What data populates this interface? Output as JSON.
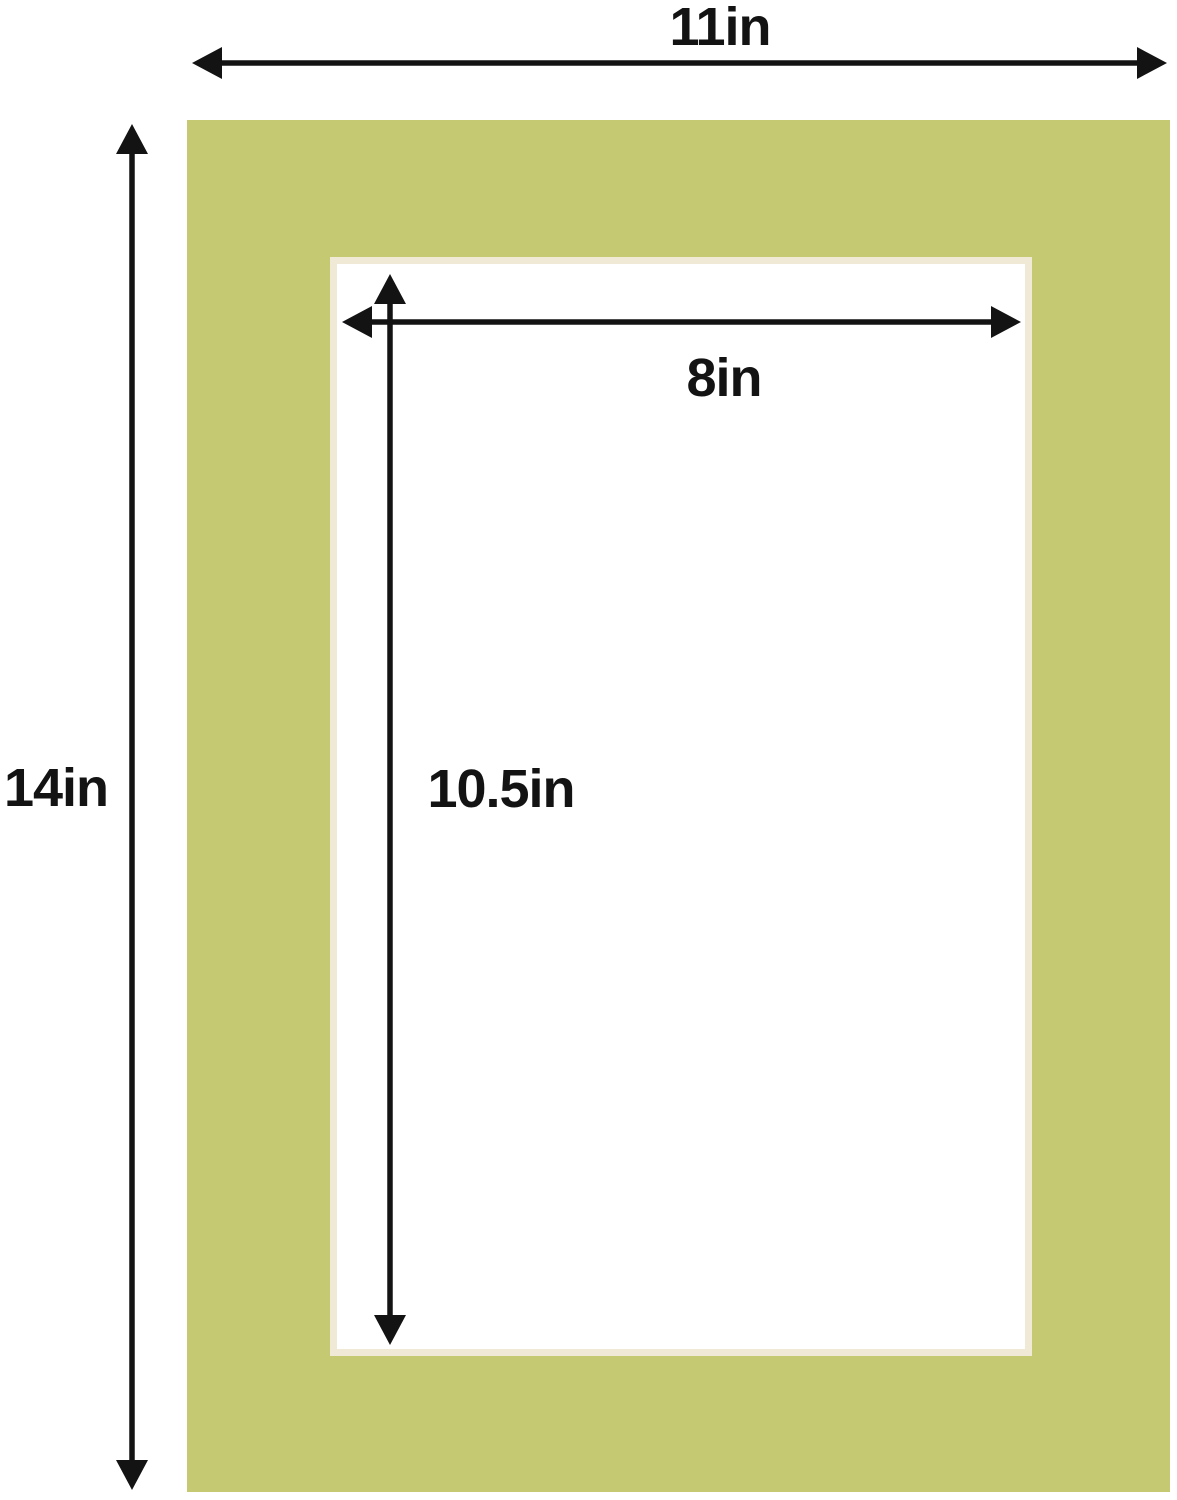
{
  "diagram": {
    "kind": "picture-mat-dimension-diagram",
    "labels": {
      "outer_width": "11in",
      "outer_height": "14in",
      "opening_width": "8in",
      "opening_height": "10.5in"
    }
  },
  "colors": {
    "mat_green": "#c5c972",
    "bevel_cream": "#efe9d6",
    "background": "#ffffff",
    "dimension_lines": "#131313",
    "label_text": "#131313"
  }
}
